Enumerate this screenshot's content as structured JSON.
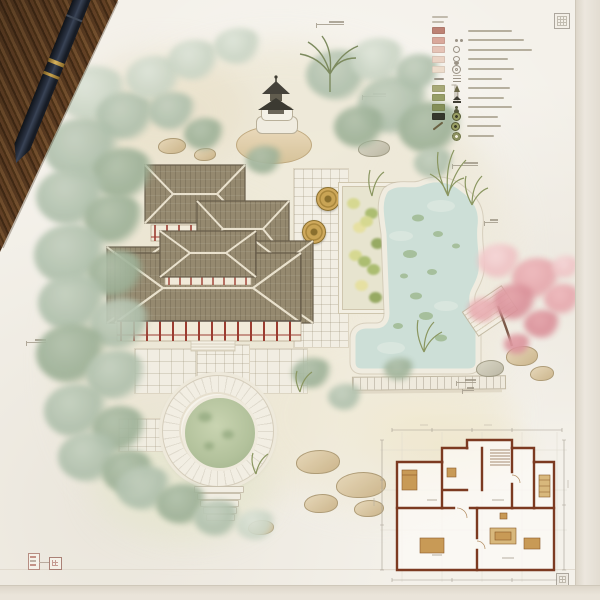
{
  "scene": {
    "title": "watercolor-chinese-garden-site-plan",
    "media": "ink-and-watercolor-drawing-on-paper",
    "props": [
      "wooden-desk-corner",
      "fountain-pen"
    ]
  },
  "palette": {
    "paper": "#f4f1ea",
    "desk_wood": "#5d3d22",
    "pen_body": "#1d2430",
    "pen_band": "#c9a44e",
    "foliage_light": "#c9d4c4",
    "foliage_mid": "#aebfab",
    "foliage_deep": "#9cb096",
    "blossom_pink": "#e5a7ac",
    "roof_tile": "#95896f",
    "timber_red": "#9c3c31",
    "wall_cream": "#f1ead9",
    "pond_water": "#cddfd7",
    "moon_pond_green": "#b3c29c",
    "stone_pale": "#f2eee3",
    "sand_wash": "#f1ead3",
    "plan_wall": "#7c3a21",
    "plan_furniture": "#c89a56",
    "annotation_gray": "#a59d8d"
  },
  "legend": {
    "header_line_widths": [
      16,
      12
    ],
    "items": [
      {
        "swatch": "#bd8274",
        "glyph": null,
        "icon": null,
        "label_w": 44
      },
      {
        "swatch": "#d9a89b",
        "glyph": null,
        "icon": "paired-circles",
        "label_w": 56
      },
      {
        "swatch": "#e5c3b6",
        "glyph": null,
        "icon": "small-ring",
        "label_w": 64
      },
      {
        "swatch": "#ead3c4",
        "glyph": null,
        "icon": "stacked-rings",
        "label_w": 40
      },
      {
        "swatch": "#eddccb",
        "glyph": null,
        "icon": "double-ring",
        "label_w": 46
      },
      {
        "swatch": null,
        "glyph": "dash",
        "icon": "wave",
        "label_w": 34
      },
      {
        "swatch": "#a8a977",
        "glyph": null,
        "icon": "tree",
        "label_w": 42
      },
      {
        "swatch": "#979e66",
        "glyph": null,
        "icon": "pagoda",
        "label_w": 36
      },
      {
        "swatch": "#848f58",
        "glyph": null,
        "icon": "figure",
        "label_w": 44
      },
      {
        "swatch": "#35362c",
        "glyph": null,
        "icon": "coin",
        "label_w": 30
      },
      {
        "swatch": null,
        "glyph": "branch",
        "icon": "coin",
        "label_w": 34
      },
      {
        "swatch": null,
        "glyph": null,
        "icon": "flower-coin",
        "label_w": 26
      }
    ]
  },
  "features": [
    "stone-pagoda-lantern",
    "main-pavilion-complex",
    "tea-terrace",
    "flower-planter",
    "koi-pond",
    "cherry-blossom-tree",
    "moon-pond",
    "entry-steps",
    "rock-garden",
    "ornamental-grasses",
    "floor-plan-inset"
  ],
  "stamps": {
    "count": 4,
    "seal_color": "#b28579",
    "corner_color": "#a09a90"
  }
}
